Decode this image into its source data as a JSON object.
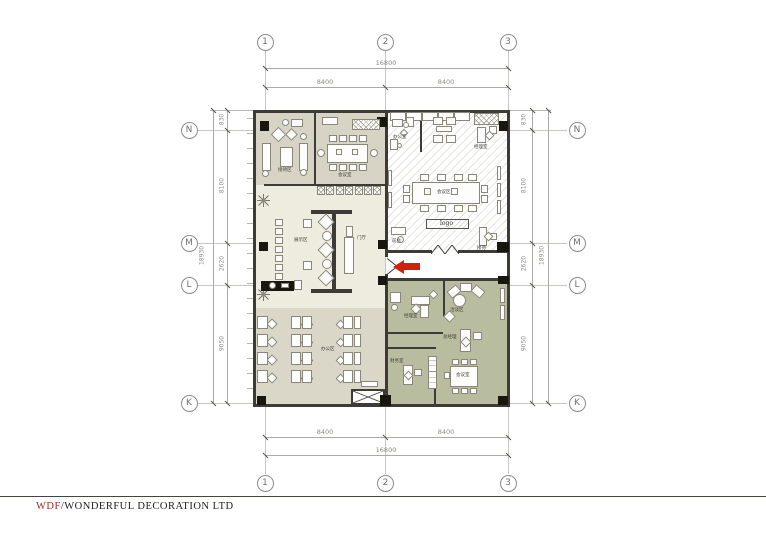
{
  "footer": {
    "brand": "WDF",
    "separator": "/",
    "company": "WONDERFUL DECORATION LTD"
  },
  "grid": {
    "columns": [
      "1",
      "2",
      "3"
    ],
    "rows": [
      "N",
      "M",
      "L",
      "K"
    ]
  },
  "dimensions": {
    "top": {
      "total": "16800",
      "left": "8400",
      "right": "8400"
    },
    "bottom": {
      "total": "16800",
      "left": "8400",
      "right": "8400"
    },
    "left": {
      "s1": "830",
      "s2": "8100",
      "s3": "2620",
      "s4": "9050",
      "total": "18930"
    },
    "right": {
      "s1": "830",
      "s2": "8100",
      "s3": "2620",
      "s4": "9050",
      "total": "18930"
    }
  },
  "rooms": {
    "reception": "接待区",
    "conference": "会议室",
    "showroom": "展示区",
    "hall": "门厅",
    "office": "办公区",
    "multi": "会议区",
    "logo": "logo",
    "office_small": "办公室",
    "manager_small": "经理室",
    "front": "前台",
    "reception_small": "接待",
    "manager": "经理室",
    "lounge": "洽谈区",
    "gm": "总经理",
    "meeting2": "会议室",
    "finance": "财务室"
  },
  "colors": {
    "arrow": "#d2200f",
    "brand_red": "#9b2b23",
    "wall": "#3c3b35",
    "floor_main": "#d7d3c5",
    "floor_showroom": "#eeebdf",
    "floor_office": "#dad6c8",
    "floor_green": "#b8bda0"
  }
}
